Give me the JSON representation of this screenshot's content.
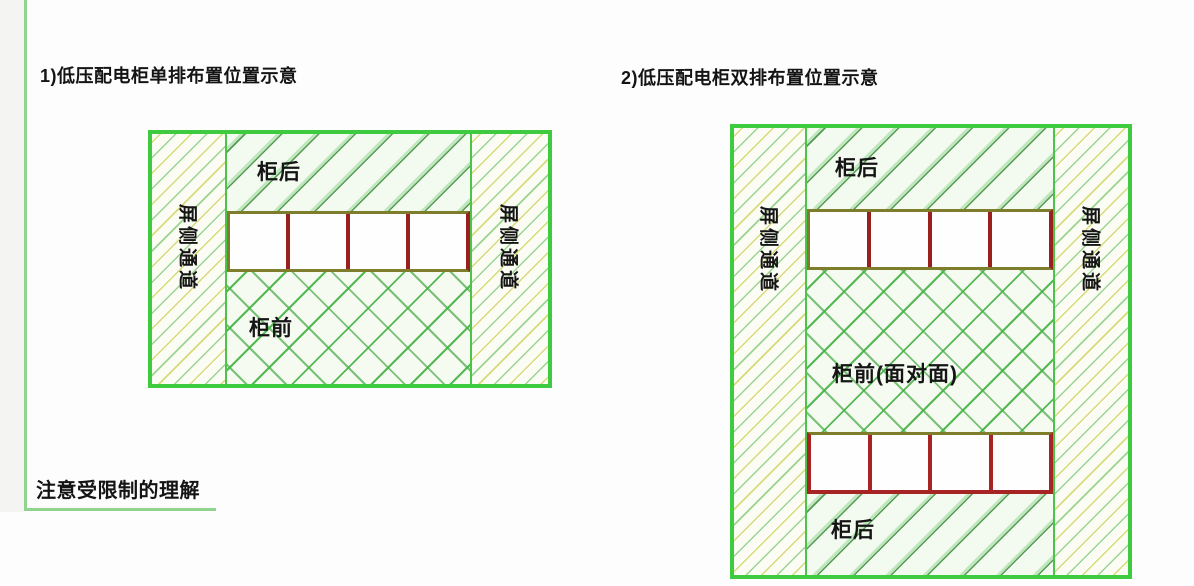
{
  "captions": {
    "title1": "1)低压配电柜单排布置位置示意",
    "title2": "2)低压配电柜双排布置位置示意",
    "note": "注意受限制的理解"
  },
  "diagram1": {
    "left_passage_label": "屏侧通道",
    "right_passage_label": "屏侧通道",
    "back_label": "柜后",
    "front_label": "柜前",
    "cabinet_row": {
      "cells": 4
    }
  },
  "diagram2": {
    "left_passage_label": "屏侧通道",
    "right_passage_label": "屏侧通道",
    "back_top_label": "柜后",
    "front_label": "柜前(面对面)",
    "back_bottom_label": "柜后",
    "cabinet_row_top": {
      "cells": 4
    },
    "cabinet_row_bottom": {
      "cells": 4
    }
  },
  "colors": {
    "diagram_border_green": "#3fcb3f",
    "frame_line_green": "#8fd48f",
    "hatch_green_dark": "#3a8a3a",
    "hatch_green_light": "#96d696",
    "hatch_yellow": "#d0d05c",
    "cabinet_outline_olive": "#7d7d2c",
    "cabinet_divider_red": "#9a2020",
    "text_color": "#151515"
  }
}
